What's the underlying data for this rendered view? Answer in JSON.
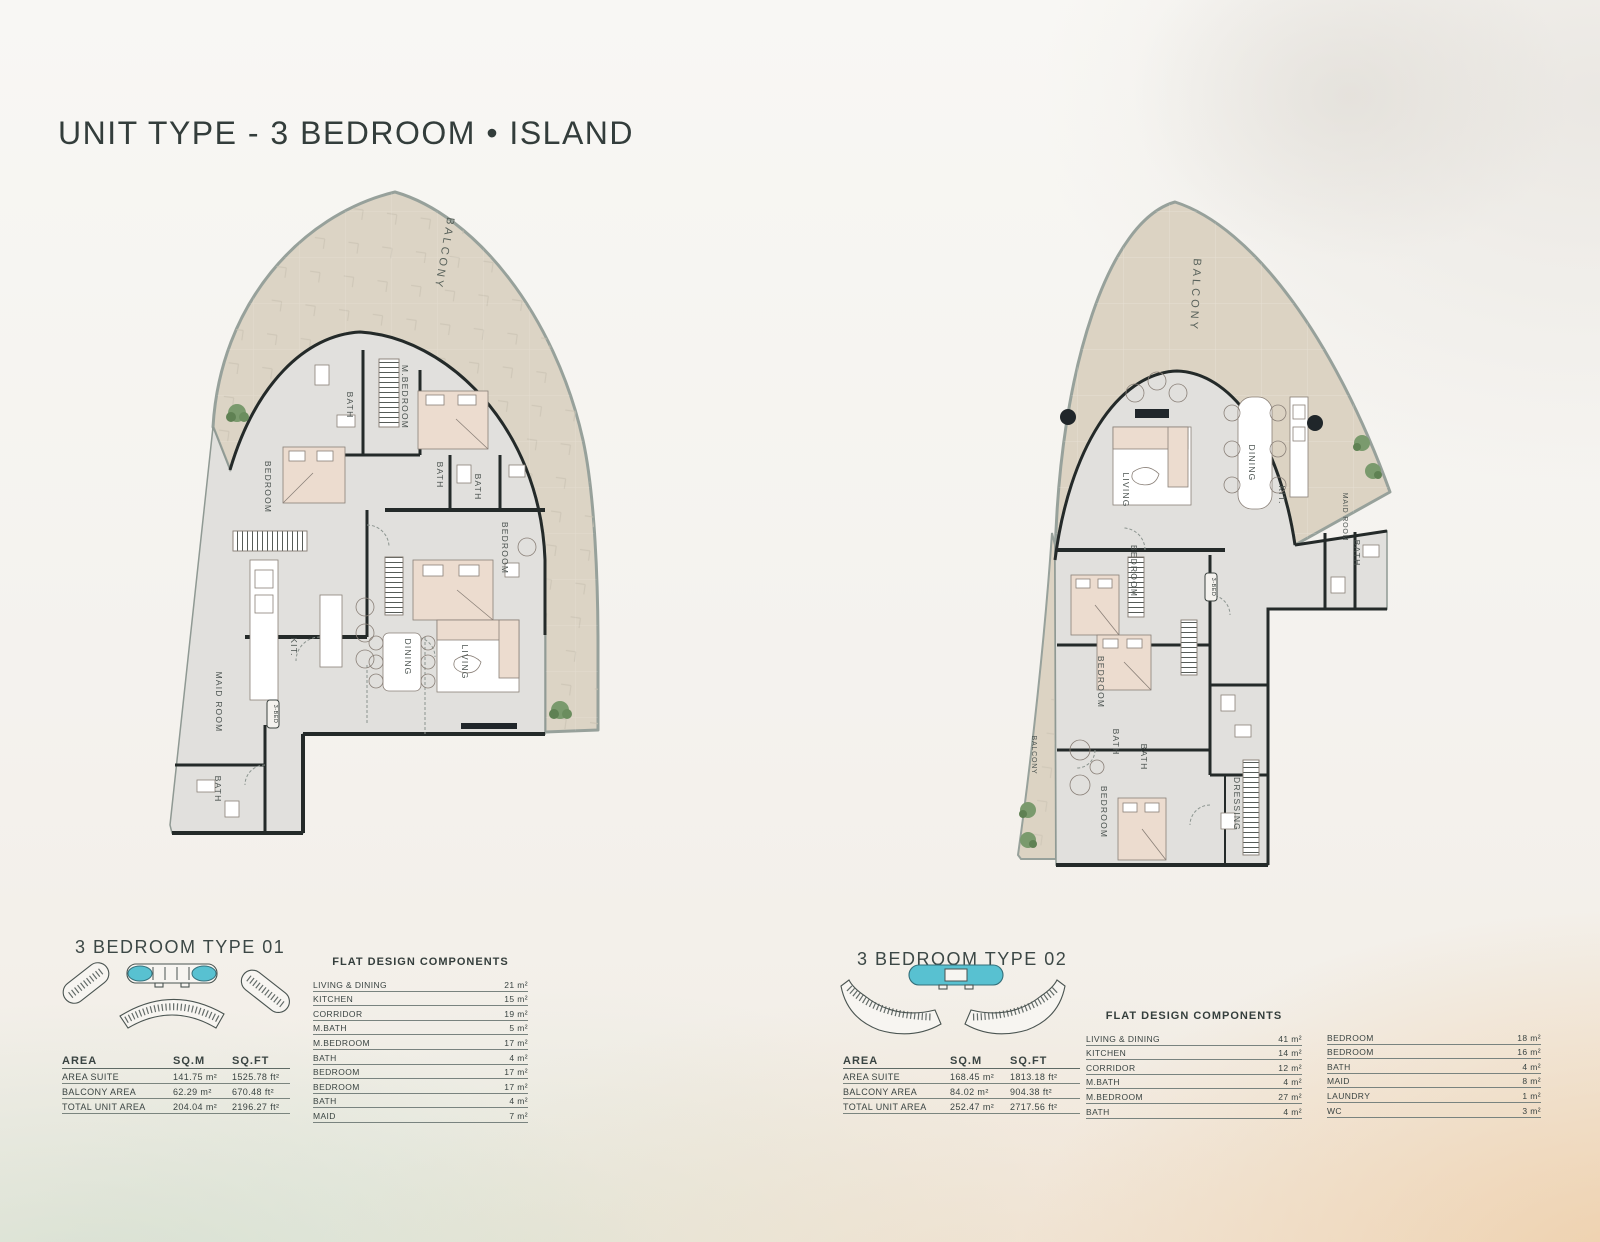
{
  "title": "UNIT TYPE - 3 BEDROOM • ISLAND",
  "colors": {
    "accent_teal": "#58c1d1",
    "balcony_fill": "#dcd4c5",
    "interior_fill": "#e1e0dd",
    "wall": "#242a29",
    "heading_text": "#3c4846",
    "sand": "#eecda6",
    "water": "#cedccb"
  },
  "plans": [
    {
      "heading": "3 BEDROOM TYPE 01",
      "badge": "3-BED",
      "room_labels": {
        "balcony": "BALCONY",
        "m_bedroom": "M.BEDROOM",
        "bath_top": "BATH",
        "bath_mid1": "BATH",
        "bath_mid2": "BATH",
        "bedroom_left": "BEDROOM",
        "bedroom_right": "BEDROOM",
        "kitchen": "KIT.",
        "dining": "DINING",
        "living": "LIVING",
        "maid_room": "MAID ROOM",
        "bath_bottom": "BATH"
      },
      "area_table": {
        "headers": [
          "AREA",
          "SQ.M",
          "SQ.FT"
        ],
        "rows": [
          {
            "label": "AREA SUITE",
            "sqm": "141.75 m²",
            "sqft": "1525.78 ft²"
          },
          {
            "label": "BALCONY AREA",
            "sqm": "62.29 m²",
            "sqft": "670.48 ft²"
          },
          {
            "label": "TOTAL UNIT AREA",
            "sqm": "204.04 m²",
            "sqft": "2196.27 ft²"
          }
        ]
      },
      "components": {
        "title": "FLAT DESIGN COMPONENTS",
        "rows": [
          {
            "label": "LIVING & DINING",
            "value": "21 m²"
          },
          {
            "label": "KITCHEN",
            "value": "15 m²"
          },
          {
            "label": "CORRIDOR",
            "value": "19 m²"
          },
          {
            "label": "M.BATH",
            "value": "5 m²"
          },
          {
            "label": "M.BEDROOM",
            "value": "17 m²"
          },
          {
            "label": "BATH",
            "value": "4 m²"
          },
          {
            "label": "BEDROOM",
            "value": "17 m²"
          },
          {
            "label": "BEDROOM",
            "value": "17 m²"
          },
          {
            "label": "BATH",
            "value": "4 m²"
          },
          {
            "label": "MAID",
            "value": "7 m²"
          }
        ]
      }
    },
    {
      "heading": "3 BEDROOM TYPE 02",
      "badge": "3-BED",
      "room_labels": {
        "balcony_top": "BALCONY",
        "living": "LIVING",
        "dining": "DINING",
        "kitchen": "KIT.",
        "maid_room": "MAID ROOM",
        "bath_upper": "BATH",
        "bedroom_top": "BEDROOM",
        "bedroom_mid": "BEDROOM",
        "bath_1": "BATH",
        "bath_2": "BATH",
        "bedroom_bottom": "BEDROOM",
        "dressing": "DRESSING",
        "balcony_left": "BALCONY"
      },
      "area_table": {
        "headers": [
          "AREA",
          "SQ.M",
          "SQ.FT"
        ],
        "rows": [
          {
            "label": "AREA SUITE",
            "sqm": "168.45 m²",
            "sqft": "1813.18 ft²"
          },
          {
            "label": "BALCONY AREA",
            "sqm": "84.02 m²",
            "sqft": "904.38 ft²"
          },
          {
            "label": "TOTAL UNIT AREA",
            "sqm": "252.47 m²",
            "sqft": "2717.56 ft²"
          }
        ]
      },
      "components": {
        "title": "FLAT DESIGN COMPONENTS",
        "col1": [
          {
            "label": "LIVING & DINING",
            "value": "41 m²"
          },
          {
            "label": "KITCHEN",
            "value": "14 m²"
          },
          {
            "label": "CORRIDOR",
            "value": "12 m²"
          },
          {
            "label": "M.BATH",
            "value": "4 m²"
          },
          {
            "label": "M.BEDROOM",
            "value": "27 m²"
          },
          {
            "label": "BATH",
            "value": "4 m²"
          }
        ],
        "col2": [
          {
            "label": "BEDROOM",
            "value": "18 m²"
          },
          {
            "label": "BEDROOM",
            "value": "16 m²"
          },
          {
            "label": "BATH",
            "value": "4 m²"
          },
          {
            "label": "MAID",
            "value": "8 m²"
          },
          {
            "label": "LAUNDRY",
            "value": "1 m²"
          },
          {
            "label": "WC",
            "value": "3 m²"
          }
        ]
      }
    }
  ]
}
